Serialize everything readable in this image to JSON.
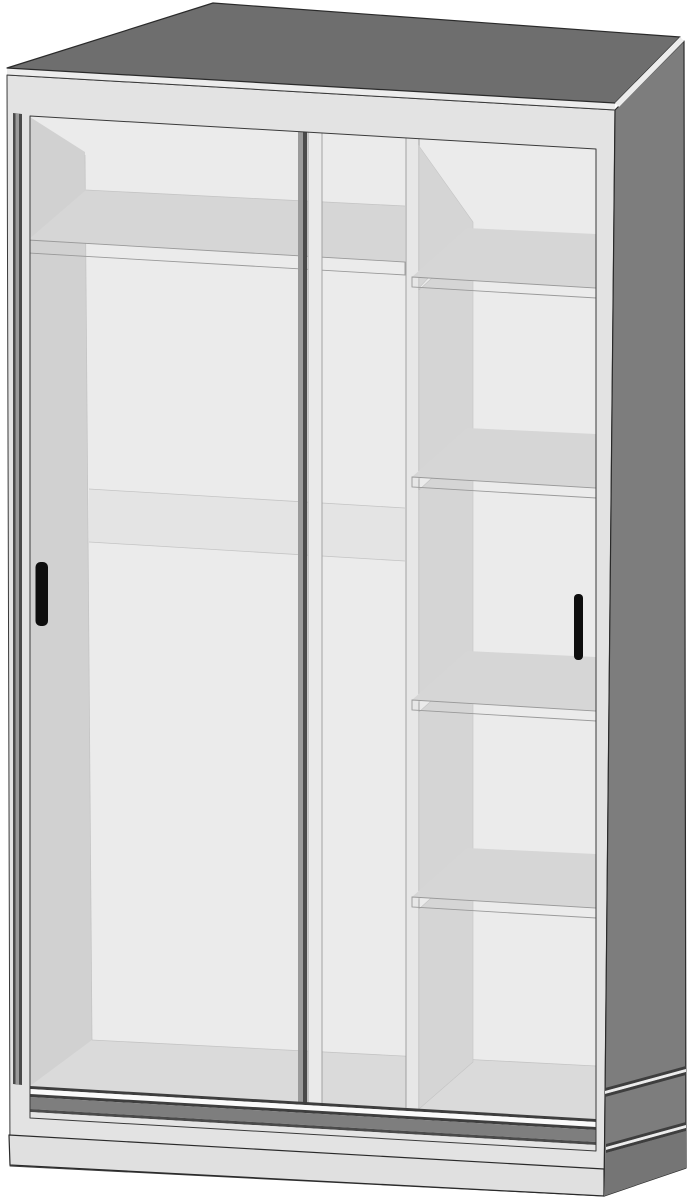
{
  "meta": {
    "title": "Sliding-door wardrobe illustration",
    "description": "Technical 3D product illustration of a tall wardrobe with two sliding doors, a left hanging compartment with one top shelf and a mid-height back rail band, a right column of five open compartments separated by four shelves, a double bottom door track and a plinth base"
  },
  "structure": {
    "doors": {
      "count": 2,
      "type": "sliding",
      "handle_style": "vertical black bar"
    },
    "left_compartment": {
      "shelves": 1,
      "mid_back_band": true
    },
    "right_column": {
      "shelves": 4,
      "compartments": 5
    },
    "base": {
      "plinth": true,
      "door_tracks": 2
    }
  },
  "colors": {
    "background": "#ffffff",
    "top_face": "#6e6e6e",
    "side_face": "#7d7d7d",
    "plinth_side": "#757575",
    "edge_strip": "#ececec",
    "frame": "#e3e3e3",
    "back_panel": "#f3f3f3",
    "wall_face": "#d7d7d7",
    "shelf_surface": "#dcdcdc",
    "shelf_edge": "#f4f4f4",
    "cubby_wall": "#dbdbdb",
    "divider_edge": "#eeeeee",
    "mid_band": "#ebebeb",
    "floor": "#e0e0e0",
    "track_dark": "#3e3e3e",
    "track_dark2": "#4a4a4a",
    "track_white": "#fafafa",
    "track_fascia": "#7e7e7e",
    "track_light": "#e4e4e4",
    "plinth_front": "#e0e0e0",
    "door_glass_tint": "rgba(140,140,140,0.07)",
    "door_stile": "#eaeaea",
    "door_edge_dark": "#4a4a4a",
    "door_edge_mid": "#9a9a9a",
    "handle": "#0e0e0e"
  }
}
